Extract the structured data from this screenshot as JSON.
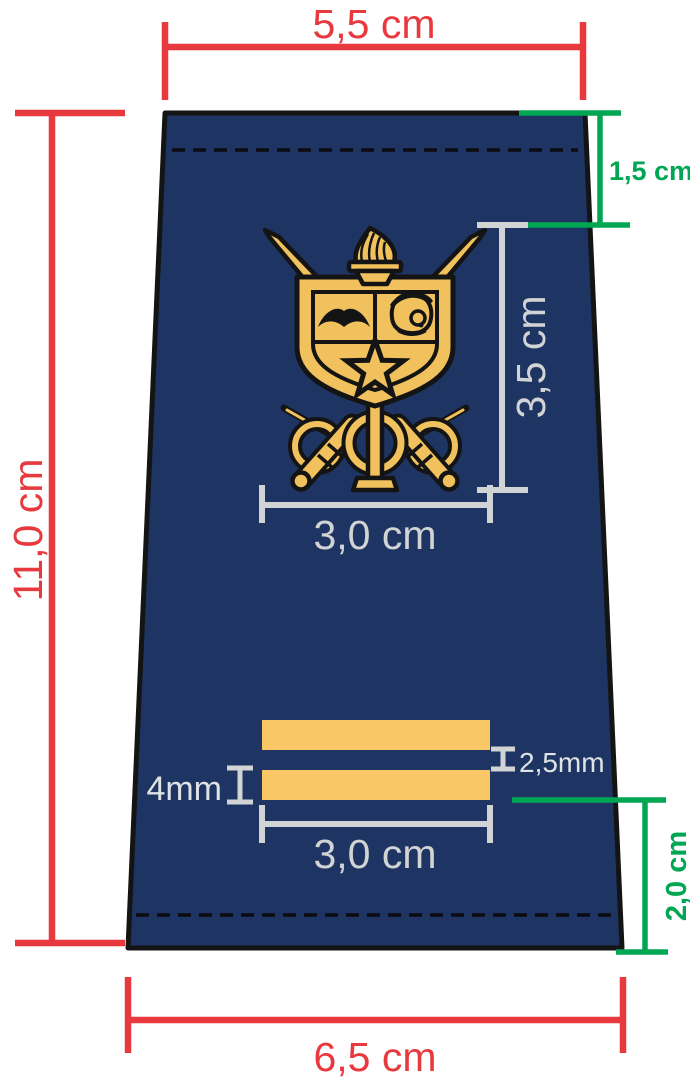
{
  "diagram_subject": "epaulette-sleeve-dimension-spec",
  "colors": {
    "fabric_navy": "#1e3563",
    "crest_gold": "#f0c15d",
    "stripe_gold": "#f9c766",
    "dimension_red": "#e8393f",
    "dimension_green": "#00a651",
    "dimension_gray": "#d1d3d4",
    "outline_black": "#141414",
    "background": "#ffffff"
  },
  "dimensions": {
    "top_width_label": "5,5 cm",
    "total_height_label": "11,0 cm",
    "bottom_width_label": "6,5 cm",
    "top_fold_label": "1,5 cm",
    "crest_height_label": "3,5 cm",
    "crest_width_label": "3,0 cm",
    "stripe_width_label": "3,0 cm",
    "stripe_thickness_label": "4mm",
    "stripe_gap_label": "2,5mm",
    "bottom_offset_label": "2,0 cm"
  }
}
